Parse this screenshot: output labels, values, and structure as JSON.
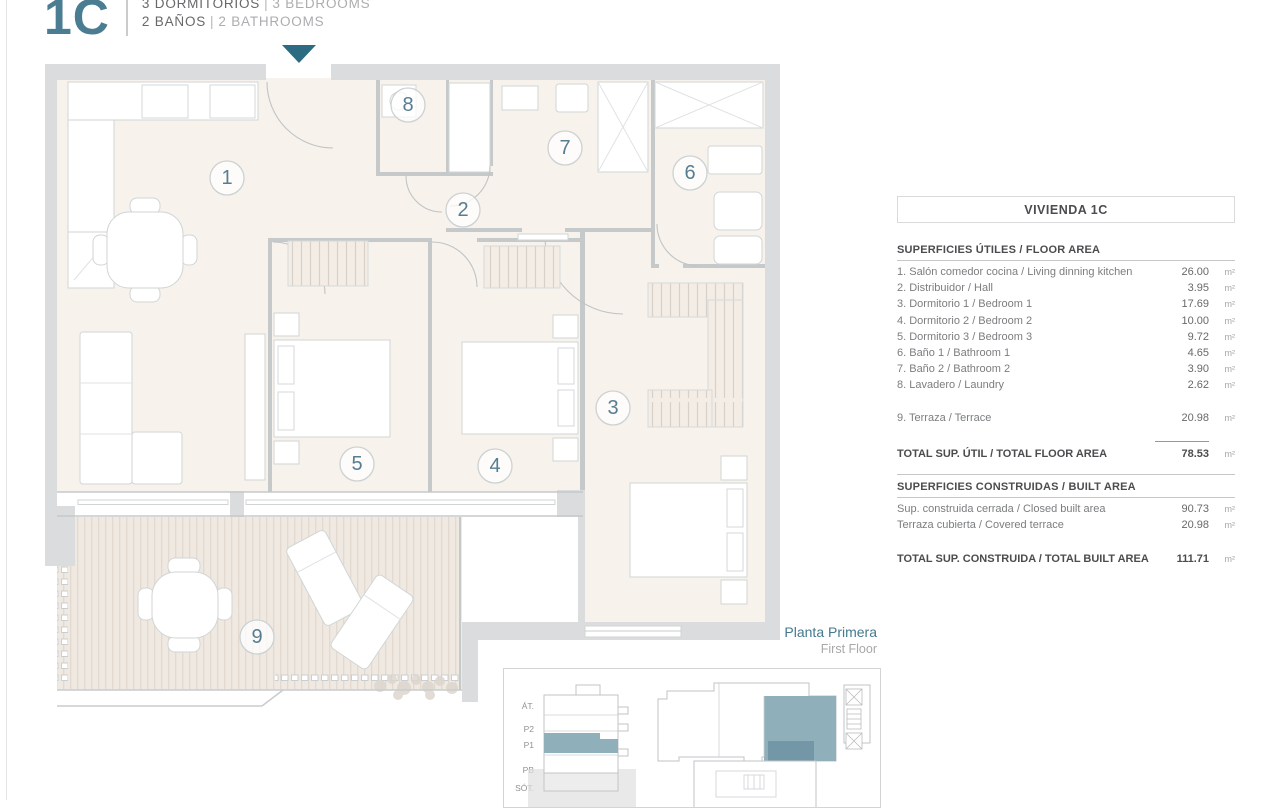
{
  "header": {
    "unit": "1C",
    "rooms_es": "3 DORMITORIOS",
    "rooms_en": "3 BEDROOMS",
    "baths_es": "2 BAÑOS",
    "baths_en": "2 BATHROOMS",
    "divider": "|"
  },
  "plan": {
    "room_numbers": [
      "1",
      "2",
      "3",
      "4",
      "5",
      "6",
      "7",
      "8",
      "9"
    ]
  },
  "panel": {
    "title": "VIVIENDA 1C",
    "floor_area": {
      "header": "SUPERFICIES ÚTILES / FLOOR AREA",
      "rows": [
        {
          "label": "1. Salón comedor cocina / Living dinning kitchen",
          "value": "26.00",
          "unit": "m²"
        },
        {
          "label": "2. Distribuidor / Hall",
          "value": "3.95",
          "unit": "m²"
        },
        {
          "label": "3. Dormitorio 1 / Bedroom 1",
          "value": "17.69",
          "unit": "m²"
        },
        {
          "label": "4. Dormitorio 2 / Bedroom 2",
          "value": "10.00",
          "unit": "m²"
        },
        {
          "label": "5. Dormitorio 3 / Bedroom 3",
          "value": "9.72",
          "unit": "m²"
        },
        {
          "label": "6. Baño 1 / Bathroom 1",
          "value": "4.65",
          "unit": "m²"
        },
        {
          "label": "7. Baño 2 / Bathroom 2",
          "value": "3.90",
          "unit": "m²"
        },
        {
          "label": "8. Lavadero / Laundry",
          "value": "2.62",
          "unit": "m²"
        }
      ],
      "terrace_row": {
        "label": "9. Terraza / Terrace",
        "value": "20.98",
        "unit": "m²"
      },
      "total": {
        "label": "TOTAL SUP. ÚTIL / TOTAL FLOOR AREA",
        "value": "78.53",
        "unit": "m²"
      }
    },
    "built_area": {
      "header": "SUPERFICIES CONSTRUIDAS / BUILT AREA",
      "rows": [
        {
          "label": "Sup. construida cerrada / Closed built area",
          "value": "90.73",
          "unit": "m²"
        },
        {
          "label": "Terraza cubierta / Covered terrace",
          "value": "20.98",
          "unit": "m²"
        }
      ],
      "total": {
        "label": "TOTAL SUP. CONSTRUIDA /  TOTAL BUILT AREA",
        "value": "111.71",
        "unit": "m²"
      }
    }
  },
  "floor_label": {
    "es": "Planta Primera",
    "en": "First Floor"
  },
  "site_plan": {
    "levels": [
      "ÁT.",
      "P2",
      "P1",
      "PB",
      "SÓT."
    ],
    "highlighted_level": "P1",
    "highlighted_unit": "1C"
  },
  "colors": {
    "teal": "#2d6b82",
    "teal_muted": "#8fafbb",
    "teal_dark_muted": "#7397a7",
    "wall_gray": "#dadcdd",
    "floor_beige": "#f7f2ec"
  }
}
